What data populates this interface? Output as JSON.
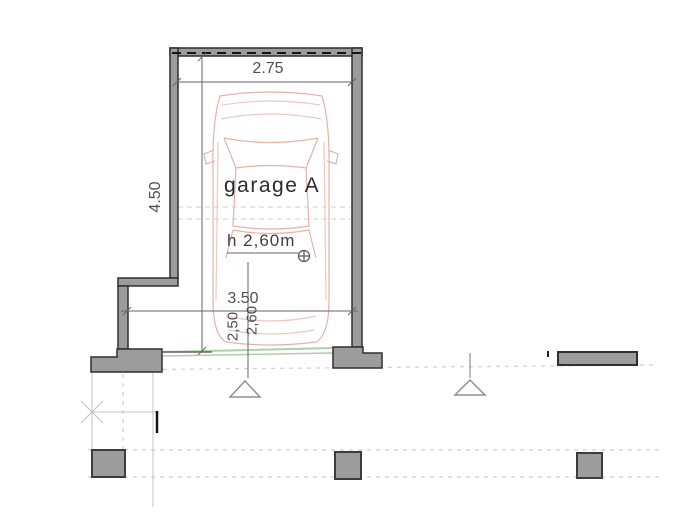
{
  "plan": {
    "room_label": "garage A",
    "height_note": "h 2,60m",
    "dim_top_width": "2.75",
    "dim_side_depth": "4.50",
    "dim_lower_width": "3.50",
    "dim_door_height": "2,60",
    "dim_door_width": "2,50"
  },
  "icons": {
    "level_marker": "circle-cross",
    "entrance_marker": "triangle-up"
  },
  "colors": {
    "wall_fill": "#9c9c9c",
    "wall_border": "#2f2f2f",
    "garage_door_green": "#aecfa8",
    "car_outline": "#e2b3aa",
    "dimension_lines": "#666666",
    "grid_dashed": "#cfcfcf",
    "text": "#3f3f3f"
  }
}
